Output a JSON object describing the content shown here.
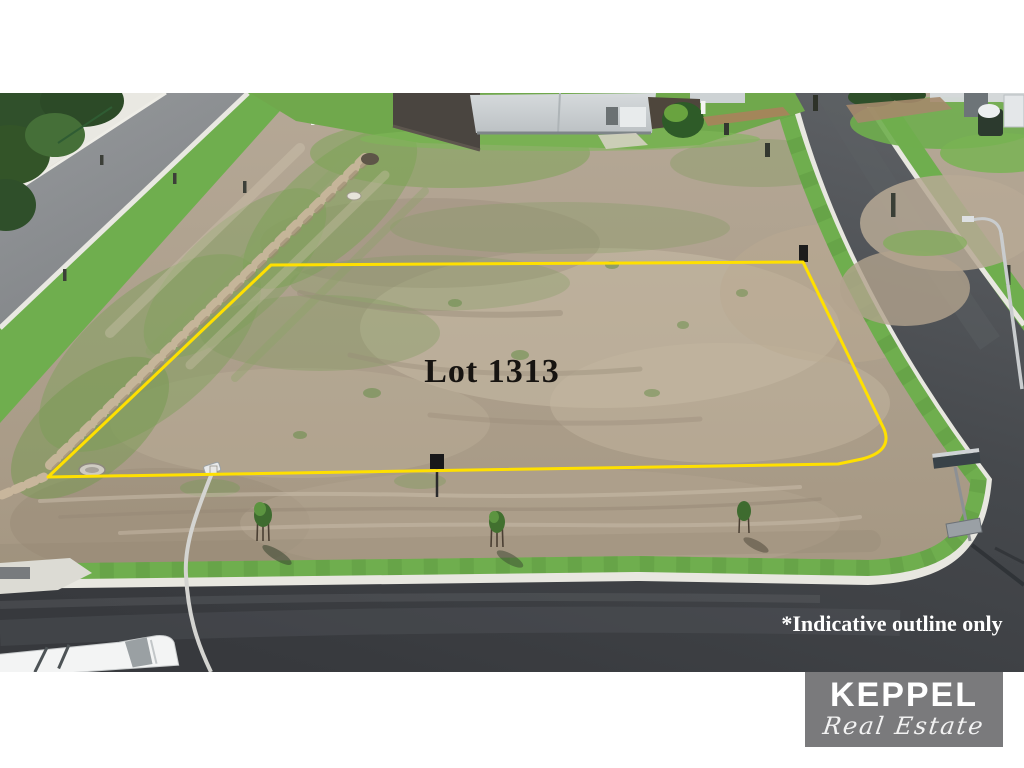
{
  "meta": {
    "kind": "real-estate-listing-aerial-photo",
    "subject": "vacant corner land lot in new residential estate"
  },
  "photo": {
    "lot_label": "Lot 1313",
    "disclaimer": "*Indicative outline only",
    "outline_color": "#ffe000",
    "lot_label_color": "#171411",
    "disclaimer_color": "#ffffff"
  },
  "logo": {
    "brand": "KEPPEL",
    "tagline": "Real Estate",
    "background_color": "#7a7a7c",
    "text_color": "#ffffff"
  },
  "palette": {
    "dirt": "#ab9e8d",
    "sand": "#c8bba6",
    "grass_verge": "#6fae4e",
    "tree_green": "#2f4f2a",
    "new_asphalt": "#42464a",
    "old_asphalt": "#8e9194",
    "concrete_kerb": "#e8e7e0",
    "page_background": "#ffffff"
  }
}
